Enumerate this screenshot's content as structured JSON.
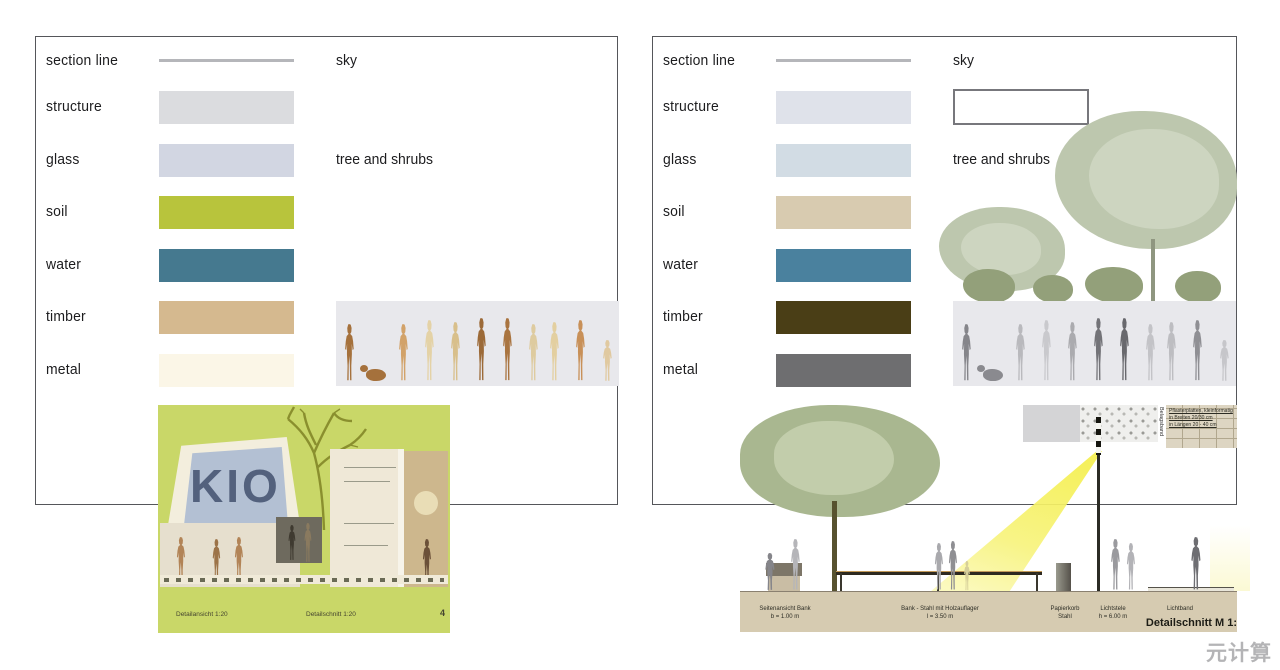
{
  "watermark": "元计算",
  "left_panel": {
    "sky_label": "sky",
    "tree_label": "tree and shrubs",
    "legend": [
      {
        "label": "section line",
        "type": "line",
        "color": "#b5b6ba"
      },
      {
        "label": "structure",
        "type": "swatch",
        "color": "#dbdcdf"
      },
      {
        "label": "glass",
        "type": "swatch",
        "color": "#d2d6e2"
      },
      {
        "label": "soil",
        "type": "swatch",
        "color": "#b8c43c"
      },
      {
        "label": "water",
        "type": "swatch",
        "color": "#45798f"
      },
      {
        "label": "timber",
        "type": "swatch",
        "color": "#d5b98f"
      },
      {
        "label": "metal",
        "type": "swatch",
        "color": "#fbf6e7"
      }
    ],
    "people_colors": [
      "#a5713c",
      "#d2a269",
      "#e4d2a6",
      "#d8bf8b",
      "#9c6a38",
      "#a97440",
      "#decb9f",
      "#e3cfa0",
      "#c89058",
      "#e0c9a0"
    ],
    "dog_color": "#a5713c"
  },
  "right_panel": {
    "sky_label": "sky",
    "tree_label": "tree and shrubs",
    "legend": [
      {
        "label": "section line",
        "type": "line",
        "color": "#b5b6ba"
      },
      {
        "label": "structure",
        "type": "swatch",
        "color": "#dfe2ea"
      },
      {
        "label": "glass",
        "type": "swatch",
        "color": "#d2dce4"
      },
      {
        "label": "soil",
        "type": "swatch",
        "color": "#d8cbb0"
      },
      {
        "label": "water",
        "type": "swatch",
        "color": "#4a819e"
      },
      {
        "label": "timber",
        "type": "swatch",
        "color": "#4a3e16"
      },
      {
        "label": "metal",
        "type": "swatch",
        "color": "#6e6e70"
      }
    ],
    "people_colors": [
      "#85858a",
      "#b9b9bd",
      "#c9c9cd",
      "#ababaf",
      "#737378",
      "#68686d",
      "#c3c3c7",
      "#bdbdc1",
      "#8f8f94",
      "#c6c6ca"
    ],
    "dog_color": "#8a8a8f"
  },
  "left_illustration": {
    "glass_text": "KIO",
    "captions": [
      "Detailansicht  1:20",
      "Detailschnitt  1:20"
    ],
    "page_number": "4"
  },
  "right_illustration": {
    "band_label": "Belagsband",
    "paving_note": [
      "Pflasterplatten, kleinformatig",
      "in Breiten 20/30 cm",
      "in Längen 20 - 40 cm"
    ],
    "item_labels": [
      {
        "name": "Seitenansicht Bank",
        "dim": "b = 1.00 m"
      },
      {
        "name": "Bank - Stahl mit Holzauflager",
        "dim": "l = 3.50 m"
      },
      {
        "name": "Papierkorb",
        "dim": "Stahl"
      },
      {
        "name": "Lichtstele",
        "dim": "h = 6.00 m"
      },
      {
        "name": "Lichtband",
        "dim": ""
      }
    ],
    "title": "Detailschnitt M 1:"
  }
}
